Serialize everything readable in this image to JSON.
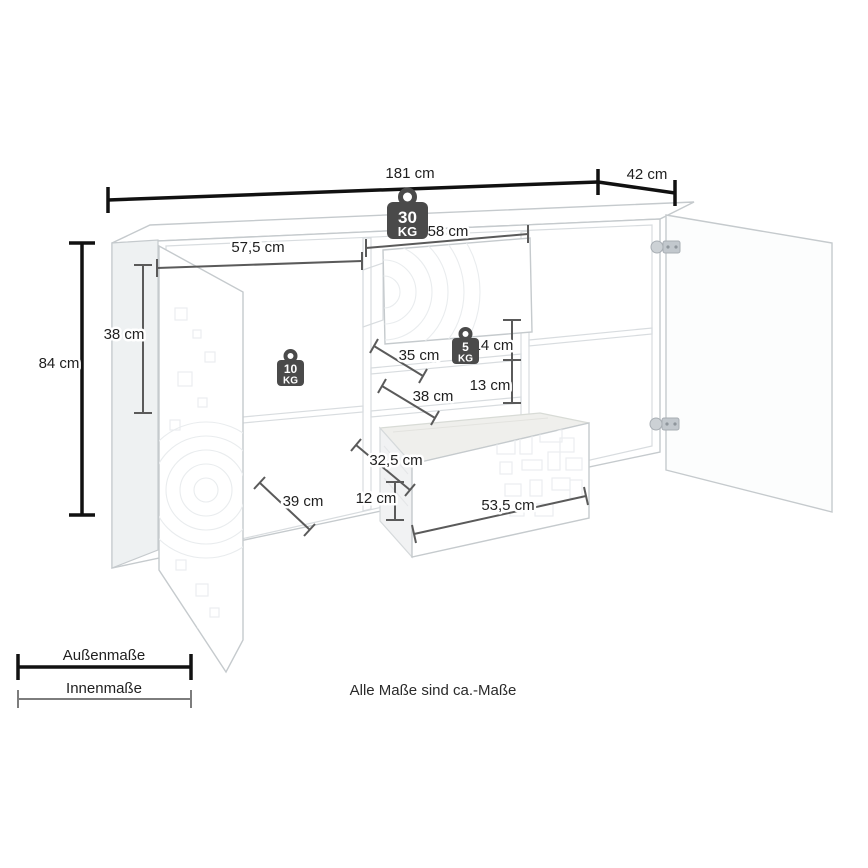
{
  "diagram": {
    "type": "furniture-dimension-drawing",
    "footnote": "Alle Maße sind ca.-Maße"
  },
  "dimensions": {
    "total_width": "181 cm",
    "total_depth": "42 cm",
    "total_height": "84 cm",
    "left_inner_height": "38 cm",
    "left_inner_width": "57,5 cm",
    "left_inner_depth": "39 cm",
    "middle_inner_width": "58 cm",
    "middle_shelf_depth": "35 cm",
    "middle_gap_upper": "14 cm",
    "middle_gap_lower": "13 cm",
    "middle_lower_shelf_depth": "38 cm",
    "drawer_inner_depth": "32,5 cm",
    "drawer_inner_height": "12 cm",
    "drawer_inner_width": "53,5 cm"
  },
  "load_limits": {
    "top": {
      "value": "30",
      "unit": "KG"
    },
    "left_shelf": {
      "value": "10",
      "unit": "KG"
    },
    "middle_shelf": {
      "value": "5",
      "unit": "KG"
    }
  },
  "legend": {
    "outer_label": "Außenmaße",
    "inner_label": "Innenmaße"
  },
  "colors": {
    "outer_dimension": "#111111",
    "inner_dimension": "#5a5a5a",
    "weight_badge": "#4a4a4a",
    "cabinet_edge": "#c5cacd",
    "background": "#ffffff",
    "text": "#1f1f1f"
  }
}
